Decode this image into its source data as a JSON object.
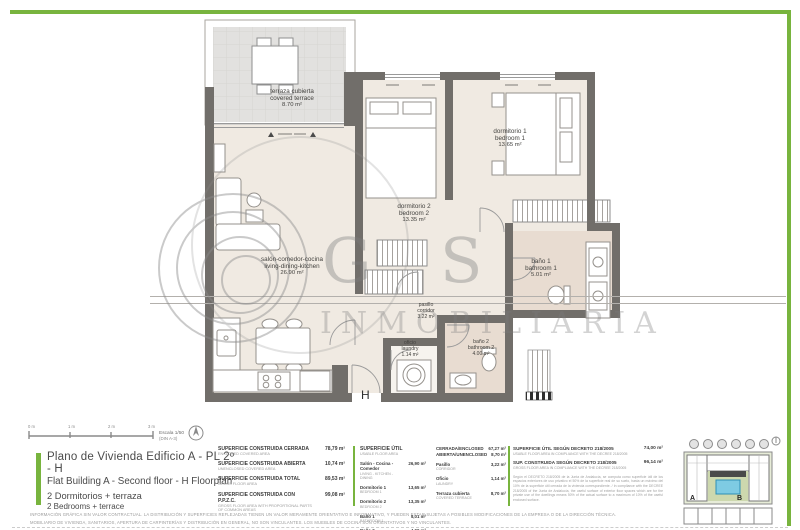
{
  "colors": {
    "accent_green": "#78b43e",
    "wall": "#716e6a",
    "floor": "#f0eae2",
    "bath_floor": "#e8dcd1",
    "terrace_floor": "#e2e1df"
  },
  "plan": {
    "unit_letter": "H",
    "rooms": [
      {
        "name_es": "terraza cubierta",
        "name_en": "covered terrace",
        "area": "8.70 m²"
      },
      {
        "name_es": "salón-comedor-cocina",
        "name_en": "living-dining-kitchen",
        "area": "26.90 m²"
      },
      {
        "name_es": "dormitorio 2",
        "name_en": "bedroom 2",
        "area": "13.35 m²"
      },
      {
        "name_es": "dormitorio 1",
        "name_en": "bedroom 1",
        "area": "13.65 m²"
      },
      {
        "name_es": "baño 1",
        "name_en": "bathroom 1",
        "area": "5.01 m²"
      },
      {
        "name_es": "pasillo",
        "name_en": "corridor",
        "area": "3.22 m²"
      },
      {
        "name_es": "oficio",
        "name_en": "laundry",
        "area": "1.14 m²"
      },
      {
        "name_es": "baño 2",
        "name_en": "bathroom 2",
        "area": "4.00 m²"
      }
    ]
  },
  "scalebar": {
    "ticks": [
      "0 m",
      "1 m",
      "2 m",
      "3 m"
    ],
    "escala": "Escala 1/50",
    "din": "(DIN A-3)"
  },
  "title_block": {
    "es_title": "Plano de Vivienda Edificio A - PL 2º - H",
    "en_title": "Flat Building A - Second floor - H  Floorplan",
    "es_sub": "2 Dormitorios + terraza",
    "en_sub": "2 Bedrooms + terrace"
  },
  "tables": {
    "built": {
      "rows": [
        {
          "es": "SUPERFICIE CONSTRUIDA CERRADA",
          "en": "ENCLOSED COVERED AREA",
          "value": "78,79 m²"
        },
        {
          "es": "SUPERFICIE CONSTRUIDA ABIERTA",
          "en": "UNENCLOSED COVERED AREA",
          "value": "10,74 m²"
        },
        {
          "es": "SUPERFICIE CONSTRUIDA TOTAL",
          "en": "GROSS FLOOR AREA",
          "value": "89,53 m²"
        },
        {
          "es": "SUPERFICIE CONSTRUIDA CON P.P.Z.C.",
          "en": "GROSS FLOOR AREA WITH PROPORTIONAL PARTS OF COMMON AREAS",
          "value": "99,08 m²"
        }
      ]
    },
    "usable": {
      "header_es": "SUPERFICIE ÚTIL",
      "header_en": "USABLE FLOOR AREA",
      "rows": [
        {
          "es": "Salón - Cocina - Comedor",
          "en": "Living - Kitchen - Dining",
          "value": "26,90 m²"
        },
        {
          "es": "Dormitorio 1",
          "en": "Bedroom 1",
          "value": "13,65 m²"
        },
        {
          "es": "Dormitorio 2",
          "en": "Bedroom 2",
          "value": "13,35 m²"
        },
        {
          "es": "Baño 1",
          "en": "Bathroom 1",
          "value": "5,01 m²"
        },
        {
          "es": "Baño 2",
          "en": "Bathroom 2",
          "value": "4,00 m²"
        }
      ],
      "totals": [
        {
          "label": "CERRADA/ENCLOSED",
          "value": "67,27 m²"
        },
        {
          "label": "ABIERTA/UNENCLOSED",
          "value": "8,70 m²"
        }
      ],
      "rows2": [
        {
          "es": "Pasillo",
          "en": "Corridor",
          "value": "3,22 m²"
        },
        {
          "es": "Oficio",
          "en": "Laundry",
          "value": "1,14 m²"
        },
        {
          "es": "Terraza cubierta",
          "en": "Covered terrace",
          "value": "8,70 m²"
        }
      ]
    },
    "decree": {
      "rows": [
        {
          "es": "SUPERFICIE ÚTIL SEGÚN DECRETO 218/2005",
          "en": "USABLE FLOOR AREA IN COMPLIANCE WITH THE DECREE 218/2005",
          "value": "74,00 m²"
        },
        {
          "es": "SUP. CONSTRUIDA SEGÚN DECRETO 218/2005",
          "en": "GROSS FLOOR AREA IN COMPLIANCE WITH THE DECREE 218/2005",
          "value": "96,14 m²"
        }
      ],
      "note": "Según el DECRETO 218/2005 de la Junta de Andalucía, se computa como superficie útil de los espacios exteriores de uso privativo el 50% de la superficie real de su suelo, hasta un máximo del 10% de la superficie útil cerrada de la vivienda correspondiente. / In compliance with the DECREE 218/2005 of the Junta de Andalucía, the useful surface of exterior floor spaces which are for the private use of the dwellings means 50% of the actual surface to a maximum of 10% of the useful enclosed surface."
    }
  },
  "legal": {
    "line1": "INFORMACIÓN GRÁFICA SIN VALOR CONTRACTUAL. LA DISTRIBUCIÓN Y SUPERFICIES REFLEJADAS TIENEN UN VALOR MERAMENTE ORIENTATIVO E INFORMATIVO, Y PUEDEN ESTAR SUJETAS A POSIBLES MODIFICACIONES DE LA EMPRESA O DE LA DIRECCIÓN TÉCNICA.",
    "line2": "MOBILIARIO DE VIVIENDA, SANITARIOS, APERTURA DE CARPINTERÍAS Y DISTRIBUCIÓN EN GENERAL, NO SON VINCULANTES. LOS MUEBLES DE COCINA SON ORIENTATIVOS Y NO VINCULANTES."
  },
  "keyplan": {
    "building_a": "A",
    "building_b": "B"
  },
  "watermark": {
    "letter1": "G",
    "letter2": "S",
    "word": "INMOBILIARIA"
  }
}
